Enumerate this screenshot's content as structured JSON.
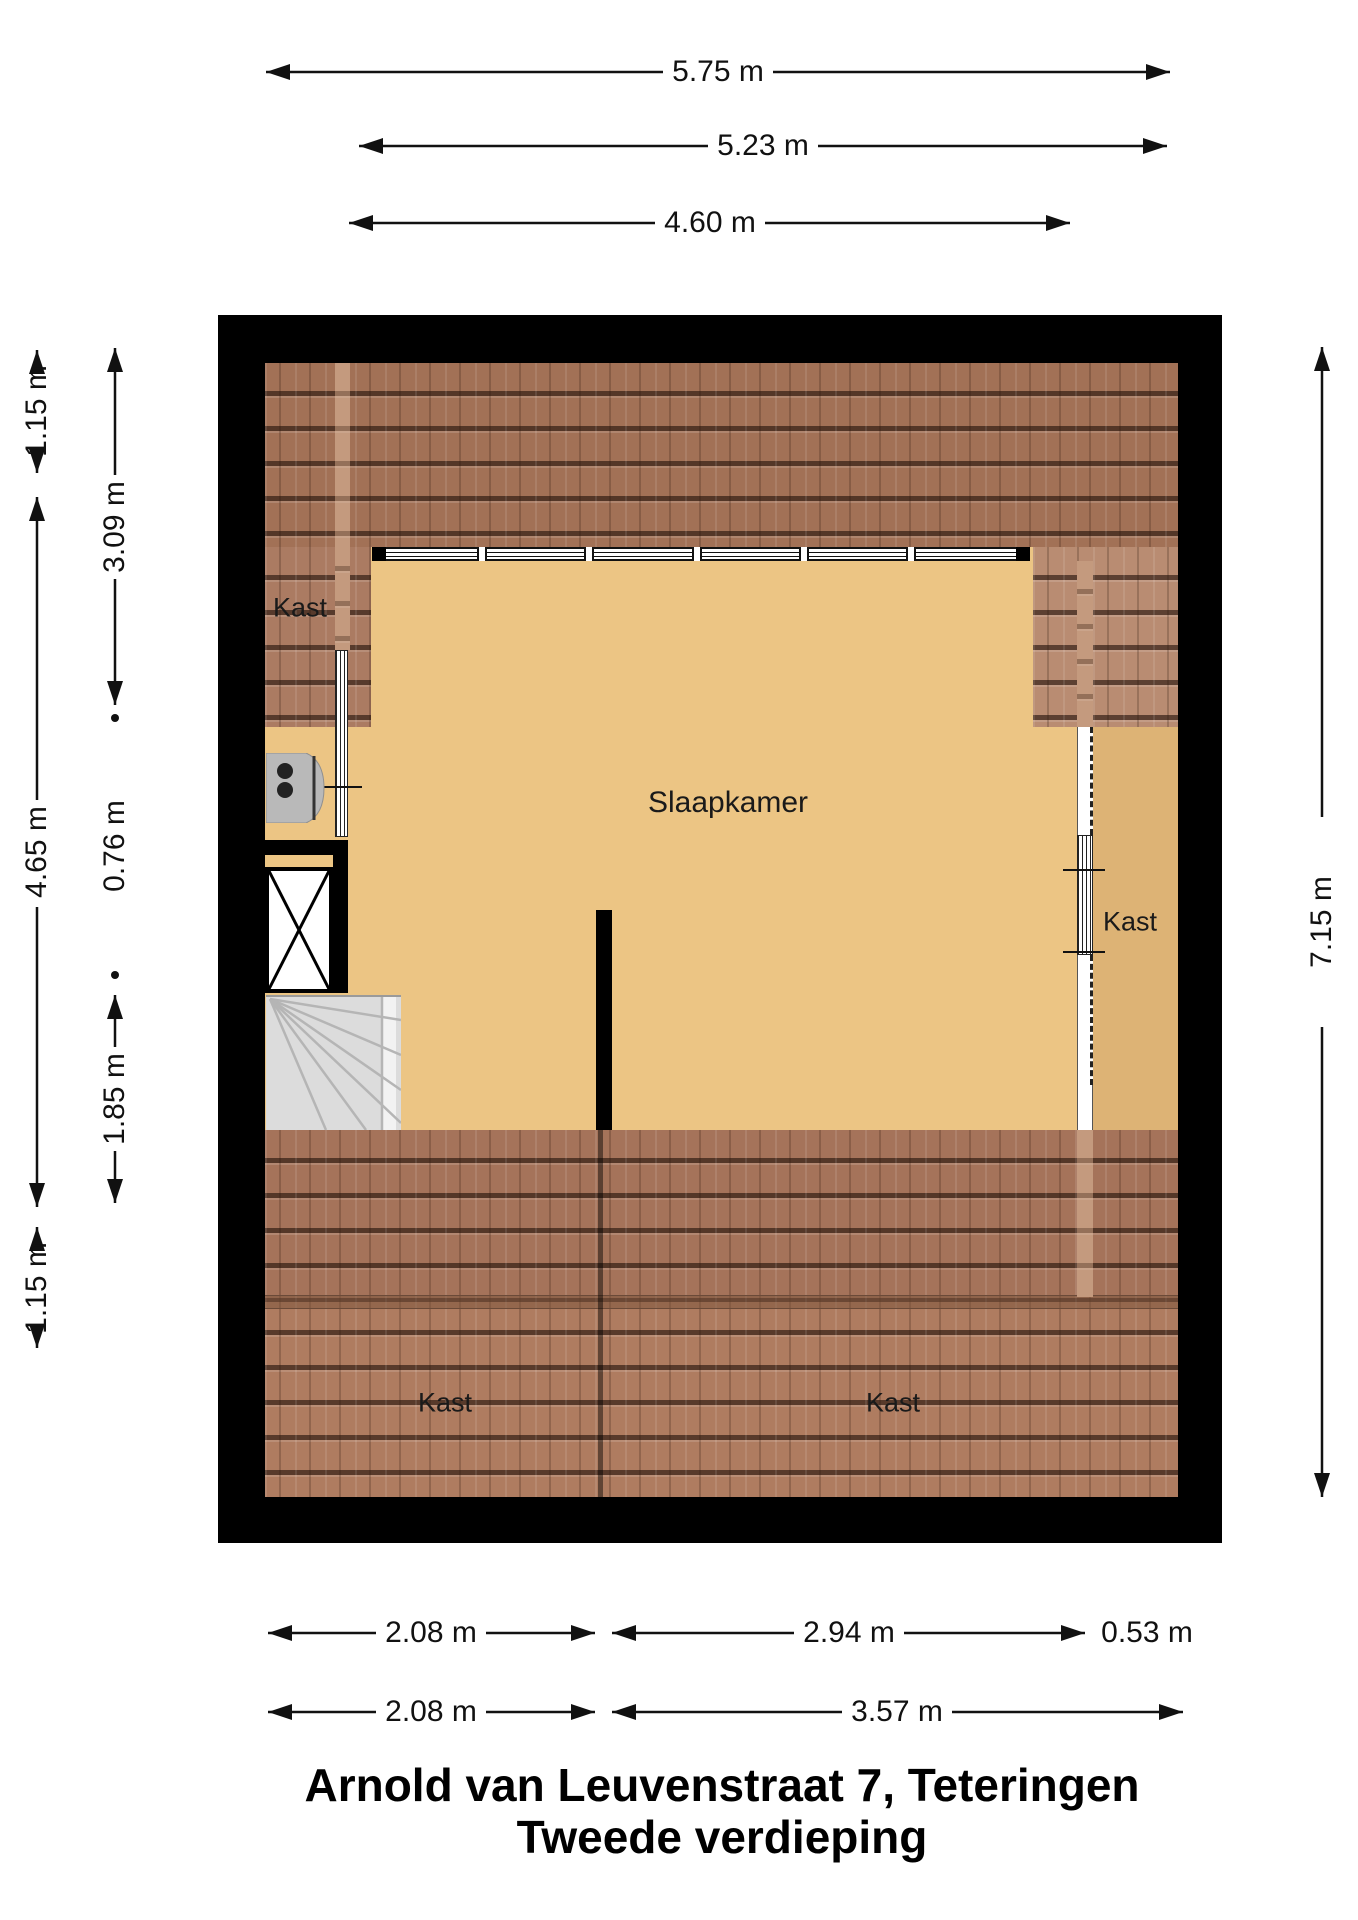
{
  "title": {
    "line1": "Arnold van Leuvenstraat 7, Teteringen",
    "line2": "Tweede verdieping"
  },
  "rooms": {
    "bedroom": "Slaapkamer",
    "closet_top_left": "Kast",
    "closet_right": "Kast",
    "closet_bottom_left": "Kast",
    "closet_bottom_right": "Kast"
  },
  "dimensions": {
    "top": [
      "5.75 m",
      "5.23 m",
      "4.60 m"
    ],
    "bottom_row1": [
      "2.08 m",
      "2.94 m",
      "0.53 m"
    ],
    "bottom_row2": [
      "2.08 m",
      "3.57 m"
    ],
    "left_outer": [
      "1.15 m",
      "4.65 m",
      "1.15 m"
    ],
    "left_inner": [
      "3.09 m",
      "0.76 m",
      "1.85 m"
    ],
    "right": [
      "7.15 m"
    ]
  },
  "colors": {
    "wall": "#000000",
    "floor": "#ecc584",
    "floor_dark": "#ddb375",
    "roof": "#a27156",
    "roof_light": "#b98c72",
    "roof_bottom": "#a5735a",
    "roof_bottom_low": "#af7c60",
    "stair": "#dcdcdc"
  }
}
